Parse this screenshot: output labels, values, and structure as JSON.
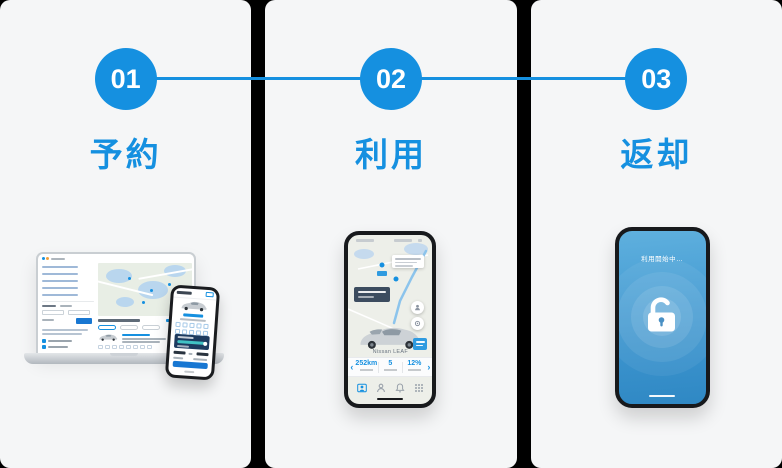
{
  "colors": {
    "accent": "#1590e0",
    "card_background": "#f5f6f7",
    "gap_background": "#000000",
    "cta_blue": "#1877d2",
    "unlock_screen_top": "#5fb0de",
    "unlock_screen_bottom": "#2f88c4"
  },
  "steps": [
    {
      "number": "01",
      "label": "予約"
    },
    {
      "number": "02",
      "label": "利用"
    },
    {
      "number": "03",
      "label": "返却"
    }
  ],
  "use_phone": {
    "car_name": "Nissan LEAF",
    "prev_chevron": "‹",
    "next_chevron": "›",
    "stats": [
      {
        "value": "252km"
      },
      {
        "value": "5"
      },
      {
        "value": "12%"
      }
    ]
  },
  "return_phone": {
    "status_text": "利用開始中…"
  }
}
